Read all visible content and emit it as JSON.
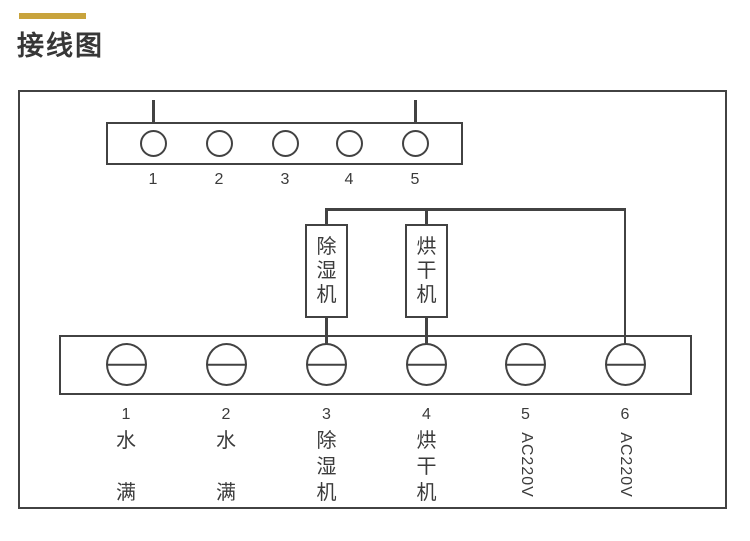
{
  "header": {
    "title": "接线图"
  },
  "colors": {
    "accent_bar": "#C8A33C",
    "diagram_line": "#424242",
    "label_text": "#3B3B3B"
  },
  "top_connector": {
    "pin_numbers": [
      "1",
      "2",
      "3",
      "4",
      "5"
    ],
    "pins_with_leads": [
      1,
      5
    ]
  },
  "components": [
    {
      "label": "除湿机",
      "label_chars": [
        "除",
        "湿",
        "机"
      ],
      "connects_to_terminal": "3"
    },
    {
      "label": "烘干机",
      "label_chars": [
        "烘",
        "干",
        "机"
      ],
      "connects_to_terminal": "4"
    }
  ],
  "bottom_terminal_block": {
    "terminals": [
      {
        "number": "1",
        "label": "水满",
        "label_chars": [
          "水",
          "",
          "满"
        ],
        "rotated": false,
        "wired": false
      },
      {
        "number": "2",
        "label": "水满",
        "label_chars": [
          "水",
          "",
          "满"
        ],
        "rotated": false,
        "wired": false
      },
      {
        "number": "3",
        "label": "除湿机",
        "label_chars": [
          "除",
          "湿",
          "机"
        ],
        "rotated": false,
        "wired": true
      },
      {
        "number": "4",
        "label": "烘干机",
        "label_chars": [
          "烘",
          "干",
          "机"
        ],
        "rotated": false,
        "wired": true
      },
      {
        "number": "5",
        "label": "AC220V",
        "label_chars": [],
        "rotated": true,
        "wired": false
      },
      {
        "number": "6",
        "label": "AC220V",
        "label_chars": [],
        "rotated": true,
        "wired": true
      }
    ]
  }
}
